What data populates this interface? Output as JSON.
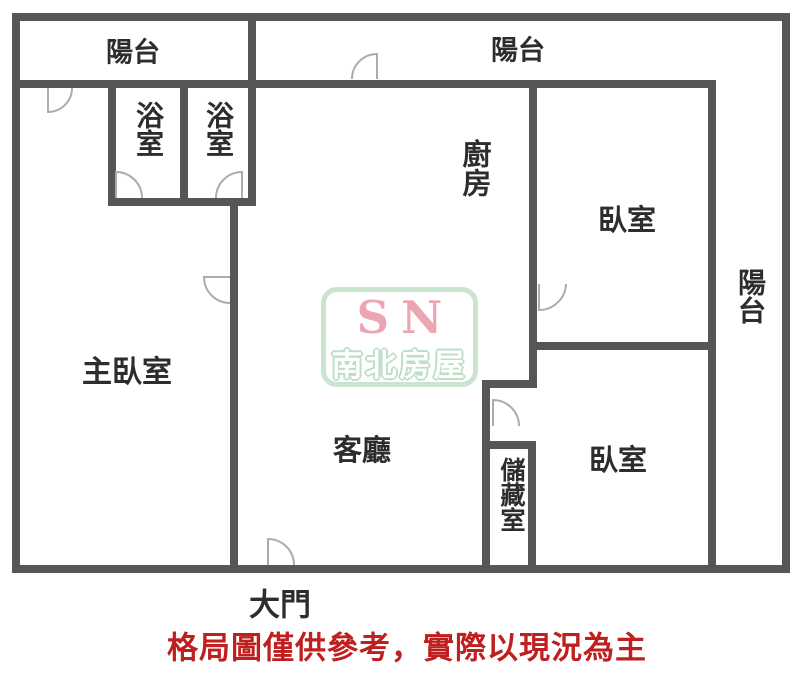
{
  "colors": {
    "background": "#ffffff",
    "wall": "#565656",
    "door_arc": "#acacac",
    "room_label": "#2d2d2d",
    "disclaimer_red": "#c01f1f",
    "logo_border_mint": "#c9e4cf",
    "logo_sn_pink": "#eca6b3",
    "logo_band_text": "#ffffff",
    "logo_band_outline": "#bedec6"
  },
  "rooms": {
    "balcony_top_left": "陽台",
    "balcony_top_right": "陽台",
    "balcony_right": "陽台",
    "bathroom_left": "浴室",
    "bathroom_right": "浴室",
    "kitchen": "廚房",
    "bedroom_upper": "臥室",
    "bedroom_lower": "臥室",
    "master_bedroom": "主臥室",
    "living_room": "客廳",
    "storage": "儲藏室",
    "main_door": "大門"
  },
  "watermark": {
    "sn": "SN",
    "company": "南北房屋"
  },
  "disclaimer": "格局圖僅供參考，實際以現況為主"
}
